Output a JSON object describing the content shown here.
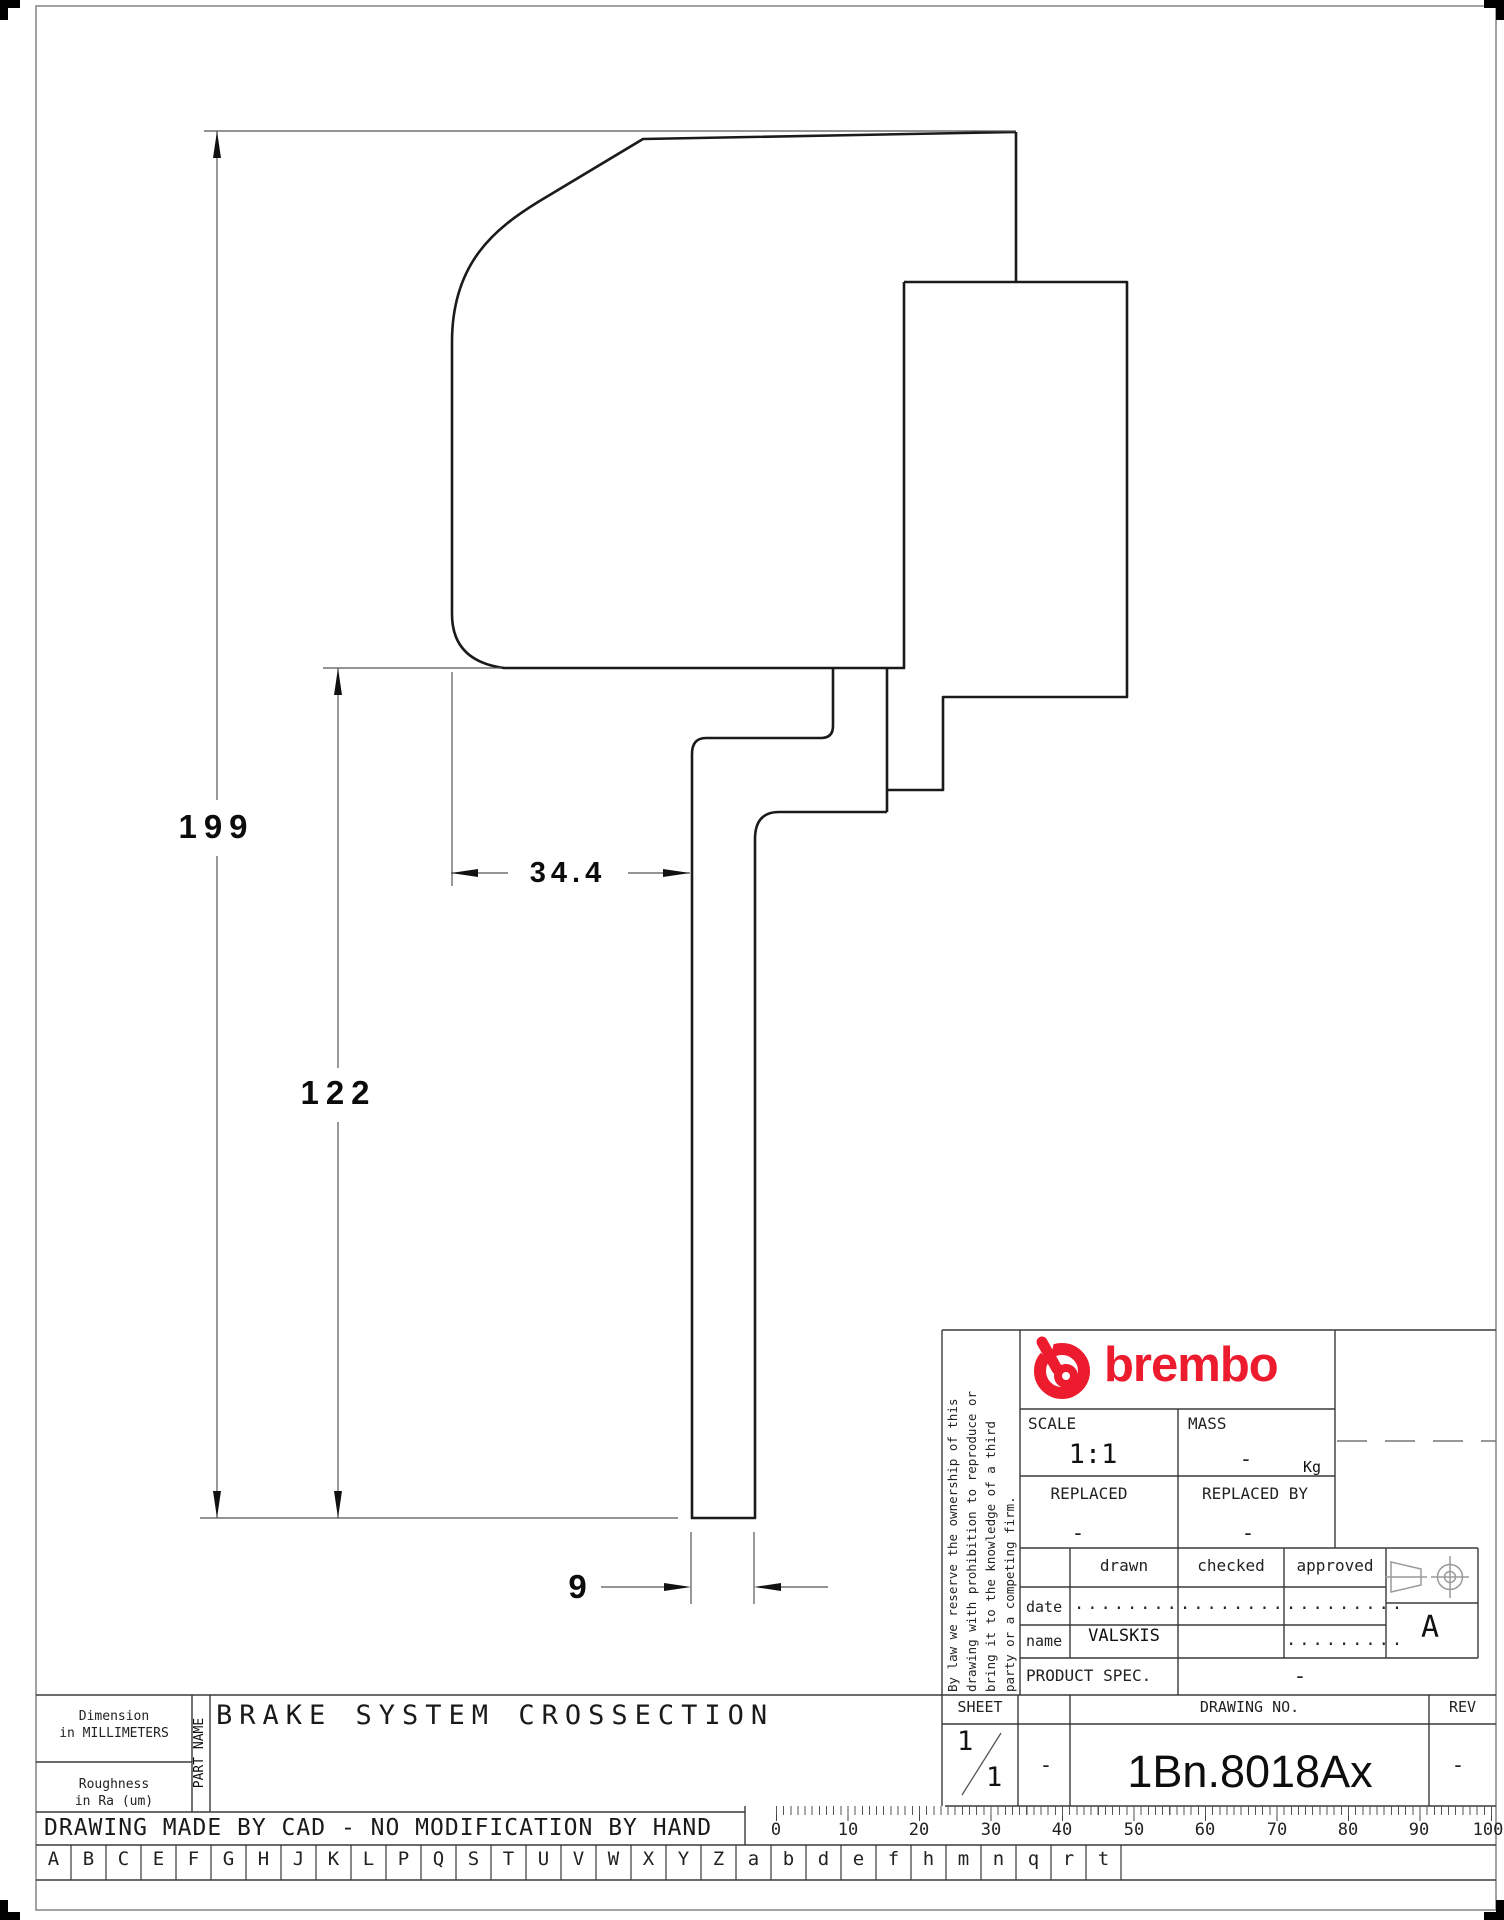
{
  "drawing": {
    "dim_height_total": "199",
    "dim_height_disc": "122",
    "dim_width_caliper": "34.4",
    "dim_disc_thickness": "9"
  },
  "title_block": {
    "brand": "brembo",
    "legal_lines": [
      "By law we reserve the ownership of this",
      "drawing with prohibition to reproduce or",
      "bring it to the knowledge of a third",
      "party or a competing firm."
    ],
    "scale_label": "SCALE",
    "scale_value": "1:1",
    "mass_label": "MASS",
    "mass_value": "-",
    "mass_unit": "Kg",
    "replaced_label": "REPLACED",
    "replaced_value": "-",
    "replaced_by_label": "REPLACED BY",
    "replaced_by_value": "-",
    "col_drawn": "drawn",
    "col_checked": "checked",
    "col_approved": "approved",
    "row_date": "date",
    "row_name": "name",
    "date_drawn": ".........",
    "date_checked": ".........",
    "date_approved": ".........",
    "name_drawn": "VALSKIS",
    "name_approved": ".........",
    "product_spec_label": "PRODUCT SPEC.",
    "product_spec_value": "-",
    "sheet_label": "SHEET",
    "sheet_current": "1",
    "sheet_total": "1",
    "sheet_extra": "-",
    "drawing_no_label": "DRAWING NO.",
    "drawing_no": "1Bn.8018Ax",
    "rev_label": "REV",
    "rev_value": "-",
    "projection_letter": "A"
  },
  "footer": {
    "dimension_note_1": "Dimension",
    "dimension_note_2": "in MILLIMETERS",
    "roughness_note_1": "Roughness",
    "roughness_note_2": "in Ra (um)",
    "part_name_label": "PART NAME",
    "part_name": "BRAKE SYSTEM CROSSECTION",
    "cad_note": "DRAWING MADE BY CAD - NO MODIFICATION BY HAND",
    "letters": [
      "A",
      "B",
      "C",
      "E",
      "F",
      "G",
      "H",
      "J",
      "K",
      "L",
      "P",
      "Q",
      "S",
      "T",
      "U",
      "V",
      "W",
      "X",
      "Y",
      "Z",
      "a",
      "b",
      "d",
      "e",
      "f",
      "h",
      "m",
      "n",
      "q",
      "r",
      "t"
    ],
    "ruler_labels": [
      "0",
      "10",
      "20",
      "30",
      "40",
      "50",
      "60",
      "70",
      "80",
      "90",
      "100"
    ]
  },
  "colors": {
    "brand_red": "#ed1b2e",
    "outline": "#1a1a1a",
    "thin_line": "#555555"
  }
}
